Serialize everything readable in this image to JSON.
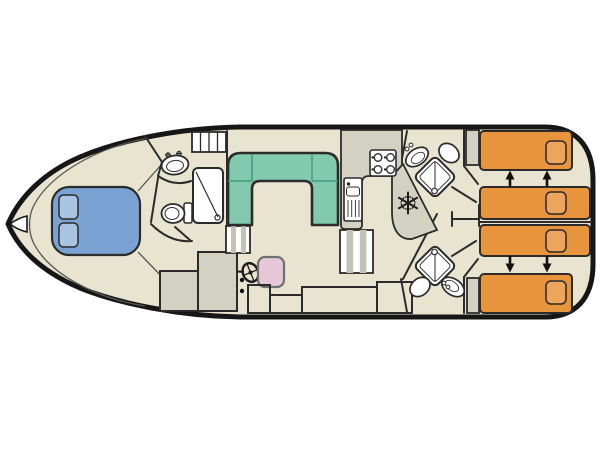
{
  "diagram": {
    "type": "boat-deck-plan",
    "orientation": "bow-left-stern-right",
    "text_labels": [],
    "rooms": [
      {
        "name": "bow-cabin",
        "furniture": [
          "double-bed-blue",
          "pillow",
          "pillow"
        ]
      },
      {
        "name": "forward-bathroom",
        "furniture": [
          "washbasin",
          "toilet",
          "shower",
          "companionway-ladder"
        ]
      },
      {
        "name": "saloon",
        "furniture": [
          "u-shaped-sofa",
          "steps",
          "helm-wheel",
          "helm-seat",
          "cabinet",
          "cabinet"
        ]
      },
      {
        "name": "galley",
        "furniture": [
          "counter",
          "stove-4-burner",
          "sink-with-drainer",
          "fridge-freezer-snowflake",
          "steps"
        ]
      },
      {
        "name": "aft-bathroom-port",
        "furniture": [
          "washbasin",
          "toilet",
          "corner-shower"
        ]
      },
      {
        "name": "aft-bathroom-starboard",
        "furniture": [
          "washbasin",
          "toilet",
          "corner-shower"
        ]
      },
      {
        "name": "aft-cabin-port",
        "furniture": [
          "single-bed",
          "single-bed",
          "bedside-unit",
          "slide-arrows"
        ]
      },
      {
        "name": "aft-cabin-starboard",
        "furniture": [
          "single-bed",
          "single-bed",
          "bedside-unit",
          "slide-arrows"
        ]
      }
    ],
    "counts": {
      "single_beds": 4,
      "double_beds": 1,
      "bathrooms": 3,
      "showers": 3,
      "slide_arrows": 4
    }
  },
  "palette": {
    "background": "#ffffff",
    "floor": "#e9e4cf",
    "deck_gray": "#d2d1c2",
    "stripe_gray": "#c3c3b5",
    "hull_outline": "#161616",
    "wall": "#2b2b2b",
    "thin_line": "#555550",
    "double_bed_blue": "#7aa2d3",
    "pillow_blue": "#a9c3e3",
    "sofa_teal": "#82c9af",
    "single_bed_orange": "#e8943d",
    "pillow_orange": "#eda55e",
    "helm_seat_pink": "#e6c7d7",
    "fixture_white": "#ffffff",
    "arrow_black": "#111111"
  }
}
